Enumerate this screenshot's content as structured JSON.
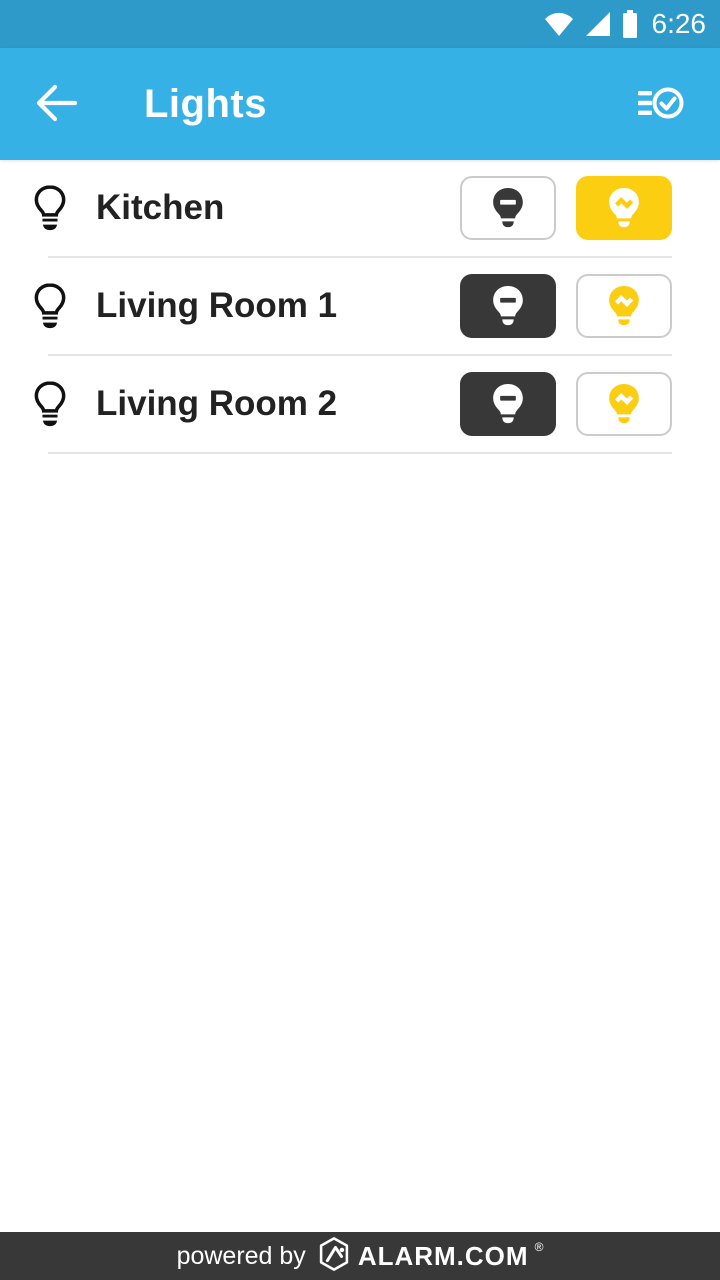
{
  "status_bar": {
    "time": "6:26",
    "icons": [
      "wifi-icon",
      "cell-signal-icon",
      "battery-icon"
    ]
  },
  "app_bar": {
    "title": "Lights",
    "back_icon": "arrow-left",
    "action_icon": "multi-select-checklist"
  },
  "lights": [
    {
      "name": "Kitchen",
      "state": "on"
    },
    {
      "name": "Living Room 1",
      "state": "off"
    },
    {
      "name": "Living Room 2",
      "state": "off"
    }
  ],
  "buttons": {
    "off_icon": "bulb-off-icon",
    "on_icon": "bulb-on-icon"
  },
  "footer": {
    "powered_by": "powered by",
    "brand": "ALARM.COM",
    "trademark": "®",
    "logo_icon": "alarm-com-hexagon-logo"
  },
  "colors": {
    "status_bar_blue": "#2E9AC9",
    "app_bar_blue": "#36B1E6",
    "accent_yellow": "#FCCE12",
    "dark_gray": "#383838",
    "text_dark": "#222222",
    "border_gray": "#CBCBCB",
    "divider_gray": "#E6E6E6"
  }
}
